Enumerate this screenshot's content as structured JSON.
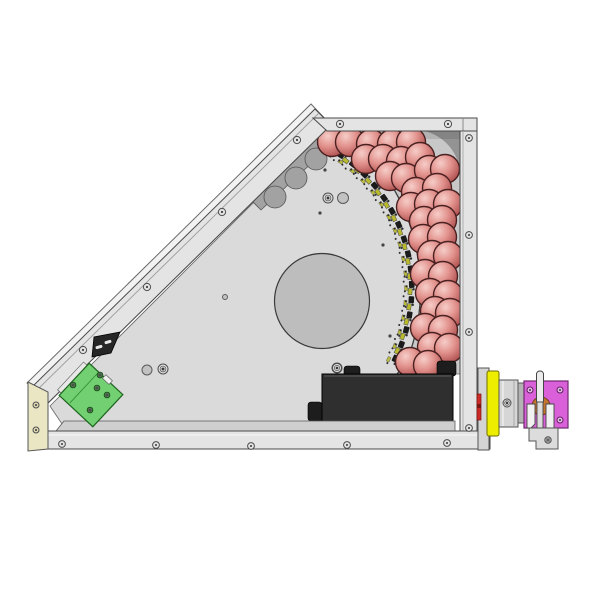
{
  "scene": {
    "canvas": {
      "w": 600,
      "h": 600,
      "bg": "#ffffff"
    },
    "palette": {
      "frame_fill": "#e4e4e4",
      "frame_stroke": "#4a4a4a",
      "frame_highlight": "#f2f2f2",
      "plate": "#dadada",
      "back": "#c8c8c8",
      "corner_shade": "#8d8d8d",
      "scallop": "#a2a2a2",
      "opening": "#bdbdbd",
      "edge": "#3f3f3f",
      "sphere_hi": "#f6cdc8",
      "sphere_mid": "#e2928d",
      "sphere_dark": "#a84746",
      "sphere_stroke": "#4a2121",
      "box": "#2f2f2f",
      "box_tab": "#1d1d1d",
      "pcb": "#72d072",
      "pcb_stroke": "#1d641d",
      "pcb_screw": "#2e7d2e",
      "cream": "#eae6c4",
      "yellow": "#eded00",
      "magenta": "#d960d9",
      "magenta_stroke": "#6f2a6f",
      "orange": "#c4752f",
      "red": "#cc2a26",
      "silver": "#ececec",
      "gray_part": "#d4d4d4",
      "screw_fill": "#e3e3e3",
      "screw_stroke": "#4d4d4d",
      "chip_dark": "#1b1b1b",
      "chip_yellow": "#b9b92e",
      "chip_dot": "#2d2d2d"
    },
    "frame": {
      "top_rail": {
        "pts": "313,118 477,118 477,131 327,131",
        "seam_x": 463
      },
      "right_wall": {
        "rect": [
          460,
          131,
          17,
          317
        ]
      },
      "bottom_lip": {
        "pts": "64,421 455,421 455,431 56,431"
      },
      "bottom_rail": {
        "pts": "46,431 490,431 490,449 42,449"
      },
      "diagonal_rail": {
        "outer_pts": "311,104 331,125 47,404 27,383",
        "pts": "315,109 331,125 47,404 31,388",
        "mid_line": [
          319,
          113,
          35,
          392
        ]
      },
      "end_cap": {
        "pts": "28,382 48,392 48,449 28,451"
      }
    },
    "back_panel": {
      "path": "M341,131 C368,150 397,183 411,228 C420,256 423,292 418,320 C413,349 407,363 397,374 L460,374 L460,131 Z",
      "corner": "M424,131 A46,46 0 0 1 460,172 L460,131 Z",
      "top_shade": [
        336,
        131,
        124,
        8
      ]
    },
    "plate": {
      "path": "M325,131 L341,131 C368,150 397,183 411,228 C420,256 423,292 418,320 C413,349 407,363 397,374 L397,424 L62,424 L50,406 Z",
      "edge_curve": "M341,131 C368,150 397,183 411,228 C420,256 423,292 418,320 C413,349 407,363 397,374",
      "opening": [
        322,
        301,
        47.5
      ],
      "holes": [
        [
          343,
          198,
          5.5
        ],
        [
          147,
          370,
          5
        ],
        [
          225,
          297,
          2.5
        ]
      ],
      "ring_screws": [
        [
          328,
          198
        ],
        [
          163,
          369
        ],
        [
          337,
          368
        ]
      ],
      "pin_dots": [
        [
          325,
          170
        ],
        [
          320,
          213
        ],
        [
          383,
          245
        ],
        [
          390,
          336
        ]
      ]
    },
    "scallops": {
      "band": "249,198 318,134 330,146 261,210",
      "bumps": [
        [
          275,
          197,
          11
        ],
        [
          296,
          178,
          11
        ],
        [
          316,
          159,
          11
        ]
      ]
    },
    "clusters": {
      "center": [
        252,
        288
      ],
      "radius": 157,
      "angles_deg": [
        -57,
        -51.5,
        -46,
        -40.5,
        -35,
        -29.5,
        -24,
        -18.5,
        -13,
        -7.5,
        -2,
        3.5,
        9,
        14.5,
        20,
        25.5
      ]
    },
    "spheres": {
      "radius": 14.5,
      "centers": [
        [
          332,
          142
        ],
        [
          350,
          142
        ],
        [
          371,
          144
        ],
        [
          392,
          144
        ],
        [
          411,
          142
        ],
        [
          366,
          159
        ],
        [
          383,
          159
        ],
        [
          401,
          161
        ],
        [
          420,
          157
        ],
        [
          390,
          176
        ],
        [
          406,
          178
        ],
        [
          429,
          170
        ],
        [
          445,
          169
        ],
        [
          416,
          192
        ],
        [
          437,
          188
        ],
        [
          411,
          207
        ],
        [
          429,
          204
        ],
        [
          448,
          204
        ],
        [
          424,
          221
        ],
        [
          442,
          220
        ],
        [
          423,
          239
        ],
        [
          442,
          237
        ],
        [
          432,
          255
        ],
        [
          448,
          256
        ],
        [
          425,
          274
        ],
        [
          443,
          276
        ],
        [
          430,
          293
        ],
        [
          448,
          295
        ],
        [
          435,
          311
        ],
        [
          450,
          313
        ],
        [
          425,
          328
        ],
        [
          443,
          330
        ],
        [
          432,
          347
        ],
        [
          449,
          348
        ],
        [
          410,
          362
        ],
        [
          428,
          365
        ]
      ]
    },
    "electronics_box": {
      "rect": [
        322,
        374,
        131,
        60
      ],
      "tabs": [
        [
          308,
          402,
          14,
          19
        ],
        [
          344,
          366,
          16,
          11
        ],
        [
          437,
          361,
          19,
          15
        ],
        [
          343,
          434,
          11,
          8
        ]
      ]
    },
    "pcb": {
      "cx": 91,
      "cy": 395,
      "w": 46,
      "h": 44,
      "rot": 43,
      "screws": [
        [
          73,
          385
        ],
        [
          100,
          375
        ],
        [
          97,
          388
        ],
        [
          90,
          410
        ],
        [
          107,
          395
        ]
      ]
    },
    "clip": {
      "pts": "92,357 94,337 120,332 111,353",
      "slots": [
        [
          99,
          347
        ],
        [
          108,
          342
        ]
      ]
    },
    "side_assembly": {
      "plate": [
        478,
        368,
        11,
        82
      ],
      "red": [
        477,
        394,
        4,
        26
      ],
      "yellow": [
        487,
        371,
        12,
        65
      ],
      "cylinder": [
        499,
        380,
        19,
        47
      ],
      "cyl_screw": [
        507,
        403
      ],
      "ring": [
        518,
        383,
        6,
        40
      ],
      "block": [
        524,
        381,
        44,
        47
      ],
      "block_screws": [
        [
          530,
          390
        ],
        [
          560,
          390
        ],
        [
          530,
          420
        ],
        [
          560,
          420
        ]
      ],
      "hub": [
        541,
        406,
        9
      ],
      "handle": [
        536.5,
        371,
        7,
        33
      ],
      "jaw_left": "M527,404 L535,404 L535,424 L531,428 L527,428 Z",
      "jaw_right": "M546,404 L554,404 L554,428 L546,428 Z",
      "stem": [
        537,
        402,
        6,
        32
      ],
      "bracket": "M529,428 L558,428 L558,449 L536,449 L536,441 L529,441 Z",
      "bracket_screw": [
        548,
        440
      ]
    },
    "screws": {
      "top": [
        [
          340,
          124
        ],
        [
          448,
          124
        ]
      ],
      "wall": [
        [
          469,
          138
        ],
        [
          469,
          235
        ],
        [
          469,
          332
        ],
        [
          469,
          428
        ]
      ],
      "bottom": [
        [
          62,
          444
        ],
        [
          156,
          445
        ],
        [
          251,
          446
        ],
        [
          347,
          445
        ],
        [
          447,
          443
        ]
      ],
      "rail": [
        [
          297,
          140
        ],
        [
          222,
          212
        ],
        [
          147,
          287
        ],
        [
          83,
          350
        ]
      ],
      "cap": [
        [
          36,
          405
        ],
        [
          36,
          430
        ]
      ]
    }
  }
}
